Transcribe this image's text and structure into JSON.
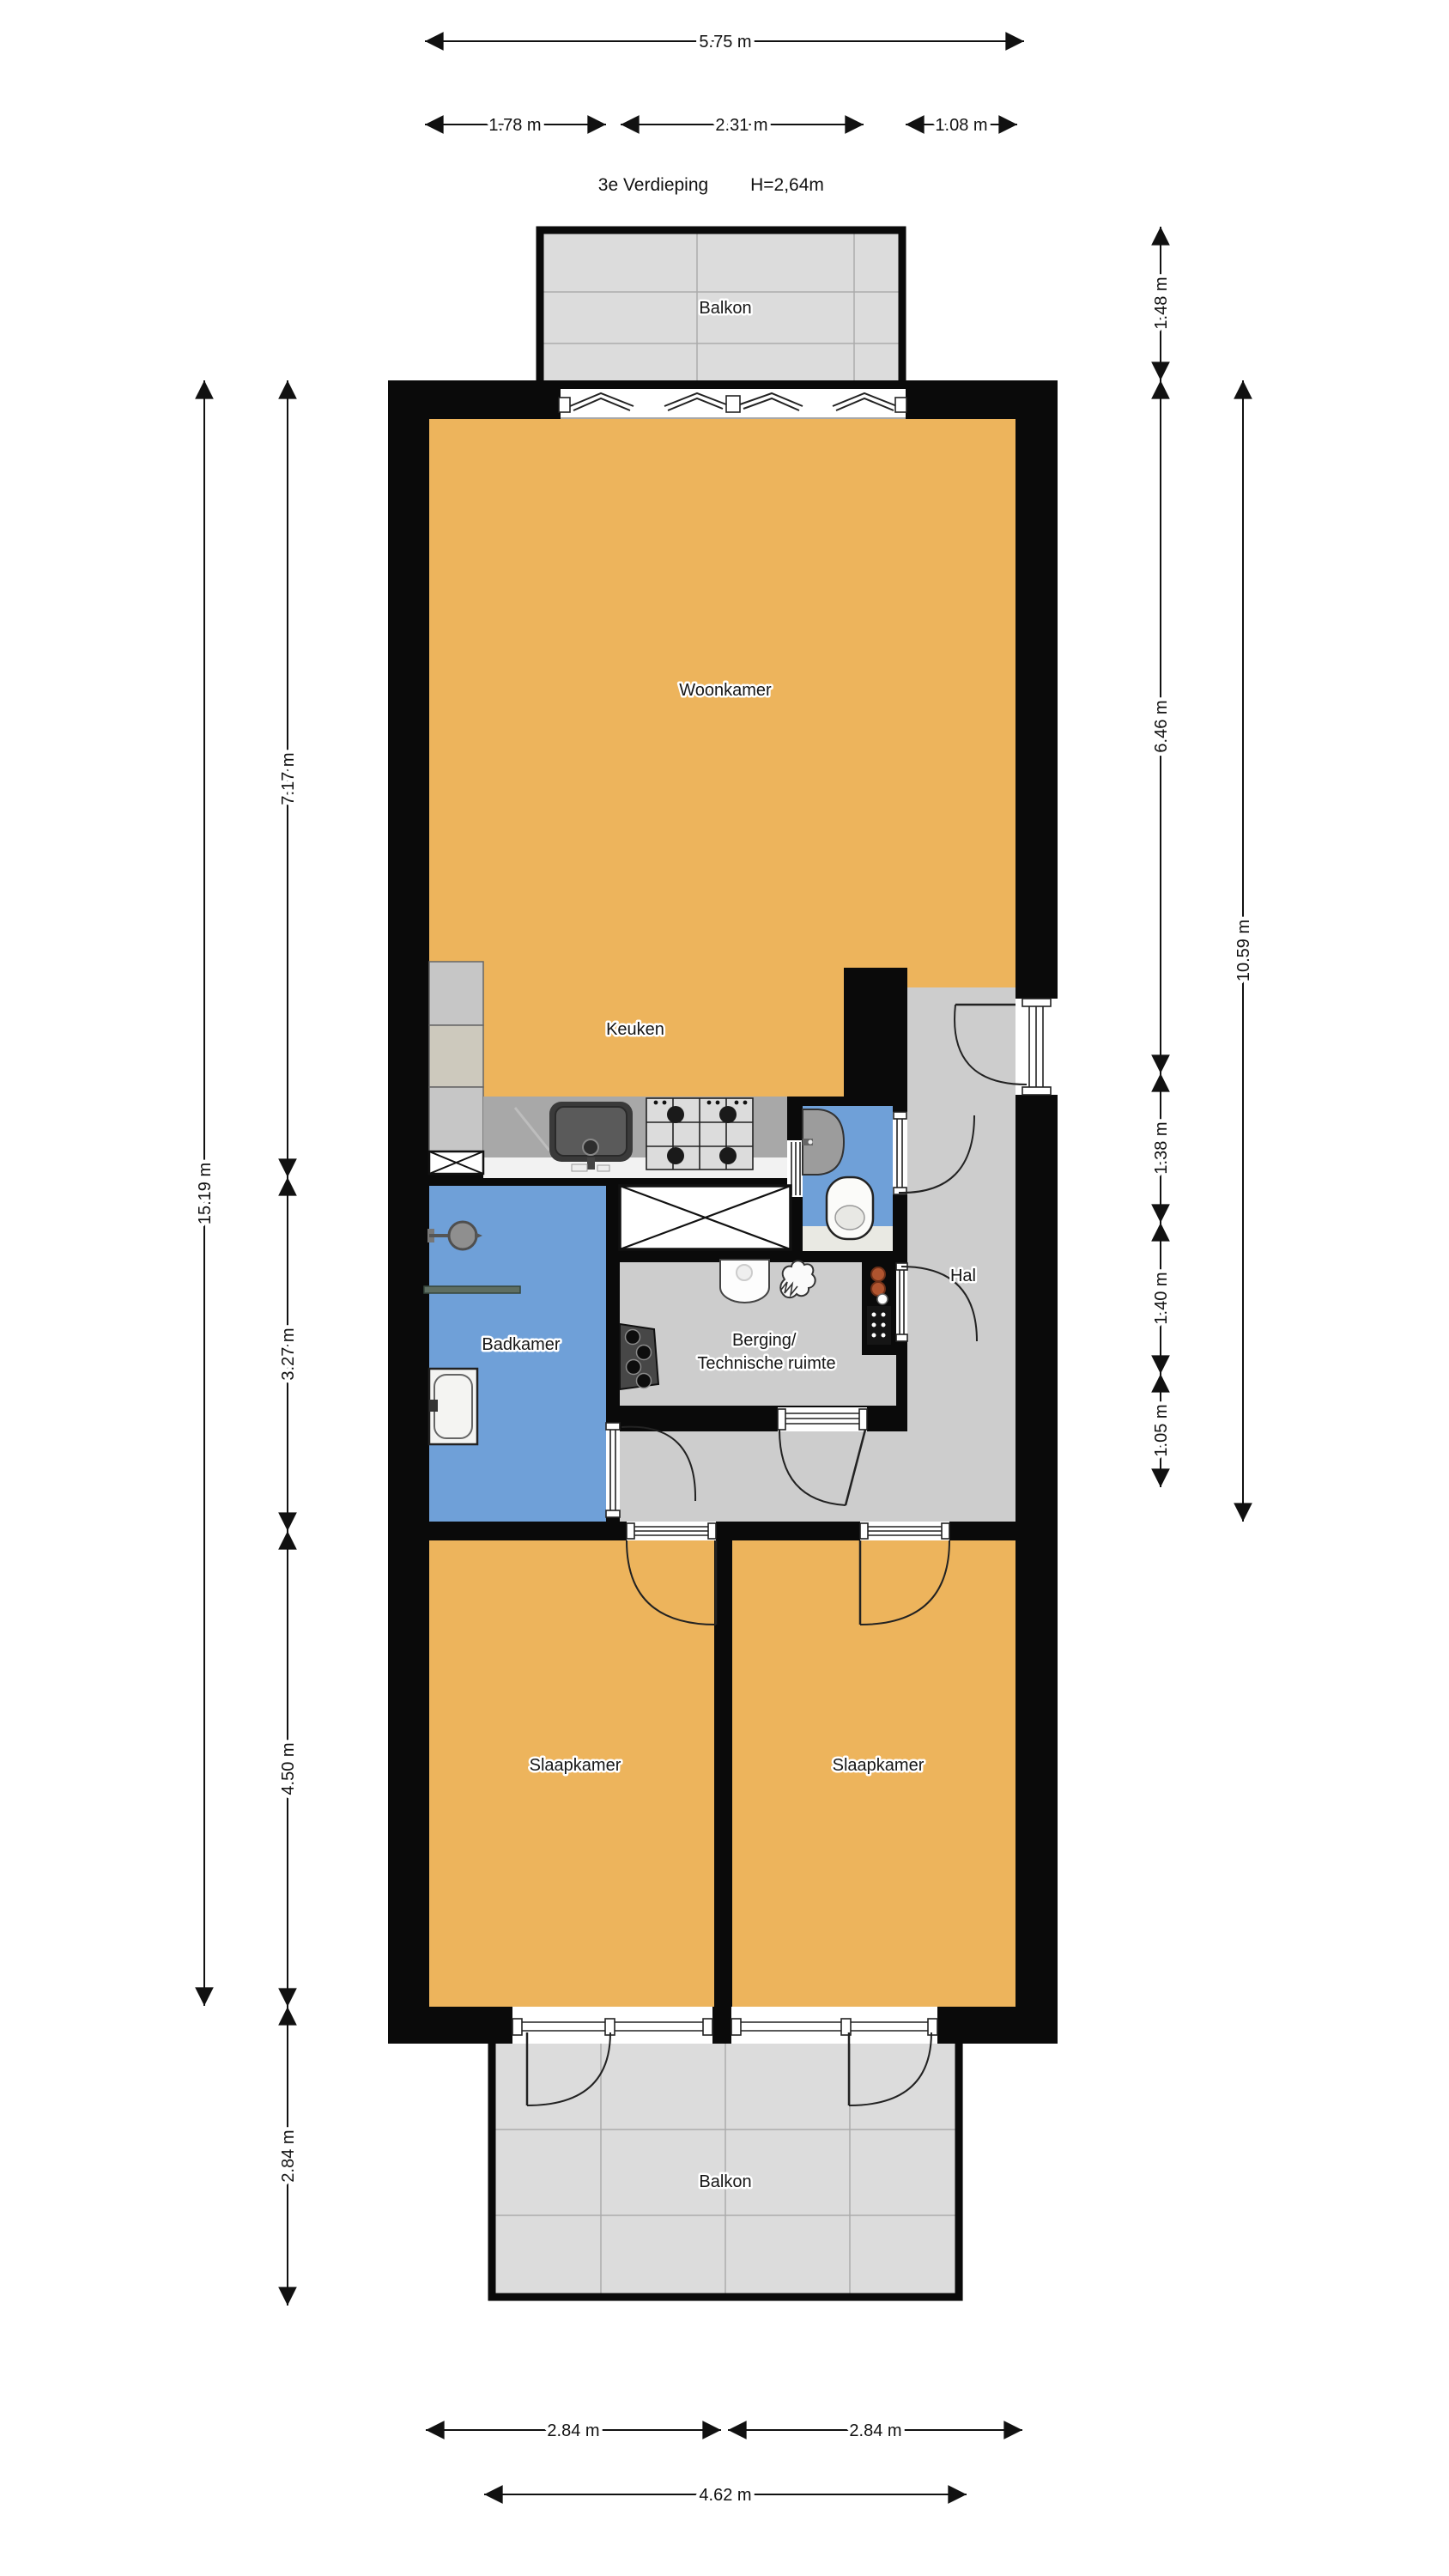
{
  "title": {
    "floor_label": "3e Verdieping",
    "height_label": "H=2,64m"
  },
  "rooms": {
    "balkon_top": "Balkon",
    "woonkamer": "Woonkamer",
    "keuken": "Keuken",
    "badkamer": "Badkamer",
    "hal": "Hal",
    "berging_line1": "Berging/",
    "berging_line2": "Technische ruimte",
    "slaapkamer_left": "Slaapkamer",
    "slaapkamer_right": "Slaapkamer",
    "balkon_bottom": "Balkon"
  },
  "dimensions": {
    "top_total": "5.75 m",
    "top_left": "1.78 m",
    "top_middle": "2.31 m",
    "top_right": "1.08 m",
    "left_total": "15.19 m",
    "left_living": "7.17 m",
    "left_bath": "3.27 m",
    "left_bedroom": "4.50 m",
    "left_balcony": "2.84 m",
    "right_balcony": "1.48 m",
    "right_living": "6.46 m",
    "right_total": "10.59 m",
    "right_hall_a": "1.38 m",
    "right_hall_b": "1.40 m",
    "right_hall_c": "1.05 m",
    "bottom_bedroom_left": "2.84 m",
    "bottom_bedroom_right": "2.84 m",
    "bottom_balcony": "4.62 m"
  },
  "colors": {
    "wall": "#0a0a0a",
    "living_orange": "#EDB45C",
    "wet_blue": "#6FA0D8",
    "hall_gray": "#CDCDCD",
    "balcony_gray": "#DCDCDC",
    "counter_gray": "#A8A8A8"
  }
}
